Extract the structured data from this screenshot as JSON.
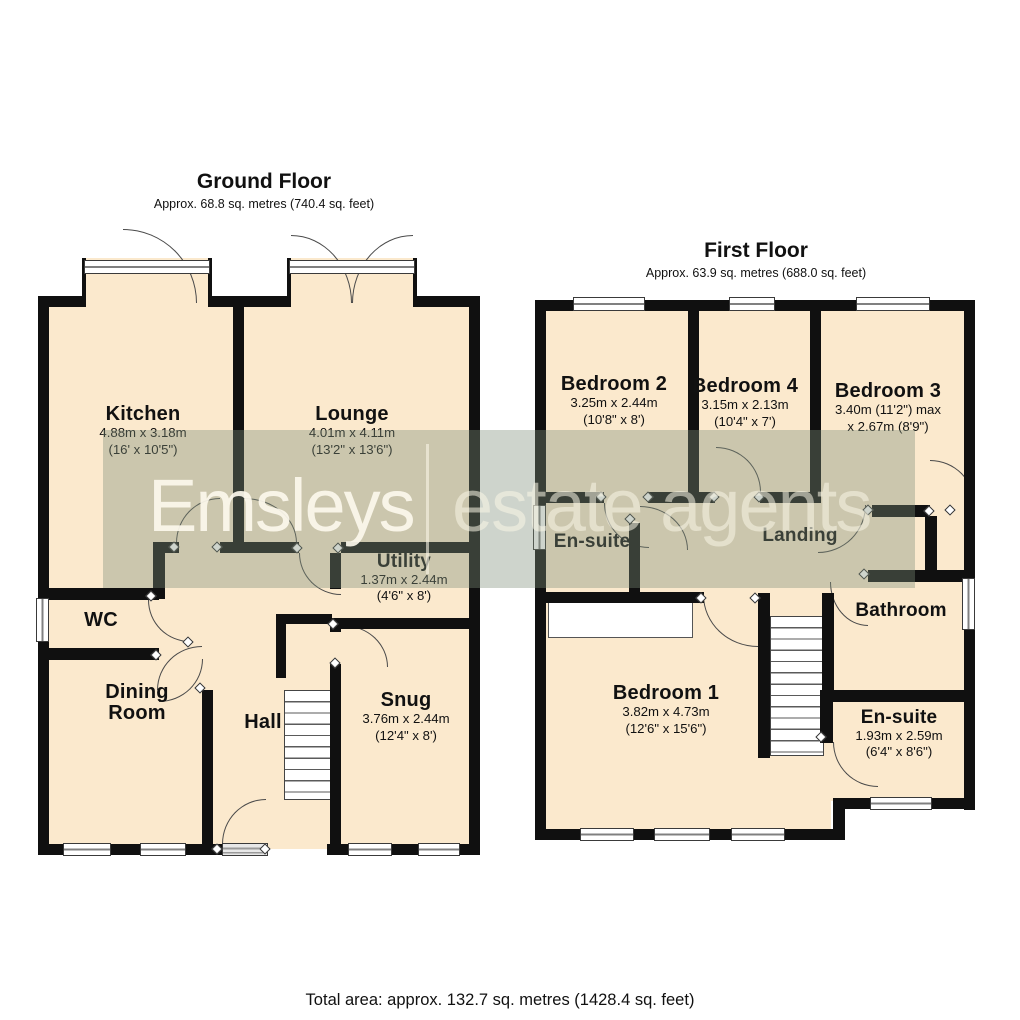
{
  "ground_floor": {
    "title": "Ground Floor",
    "subtitle": "Approx. 68.8 sq. metres (740.4 sq. feet)",
    "rooms": {
      "kitchen": {
        "name": "Kitchen",
        "metric": "4.88m x 3.18m",
        "imperial": "(16' x 10'5\")"
      },
      "lounge": {
        "name": "Lounge",
        "metric": "4.01m x 4.11m",
        "imperial": "(13'2\" x 13'6\")"
      },
      "utility": {
        "name": "Utility",
        "metric": "1.37m x 2.44m",
        "imperial": "(4'6\" x 8')"
      },
      "wc": {
        "name": "WC"
      },
      "dining_room": {
        "name": "Dining Room"
      },
      "hall": {
        "name": "Hall"
      },
      "snug": {
        "name": "Snug",
        "metric": "3.76m x 2.44m",
        "imperial": "(12'4\" x 8')"
      }
    }
  },
  "first_floor": {
    "title": "First Floor",
    "subtitle": "Approx. 63.9 sq. metres (688.0 sq. feet)",
    "rooms": {
      "bedroom2": {
        "name": "Bedroom 2",
        "metric": "3.25m x 2.44m",
        "imperial": "(10'8\" x 8')"
      },
      "bedroom4": {
        "name": "Bedroom 4",
        "metric": "3.15m x 2.13m",
        "imperial": "(10'4\" x 7')"
      },
      "bedroom3": {
        "name": "Bedroom 3",
        "metric": "3.40m (11'2\") max",
        "imperial": "x 2.67m (8'9\")"
      },
      "ensuite_front": {
        "name": "En-suite"
      },
      "landing": {
        "name": "Landing"
      },
      "bathroom": {
        "name": "Bathroom"
      },
      "bedroom1": {
        "name": "Bedroom 1",
        "metric": "3.82m x 4.73m",
        "imperial": "(12'6\" x 15'6\")"
      },
      "ensuite_rear": {
        "name": "En-suite",
        "metric": "1.93m x 2.59m",
        "imperial": "(6'4\" x 8'6\")"
      }
    }
  },
  "watermark": {
    "brand": "Emsleys",
    "suffix": "estate agents"
  },
  "footer": {
    "total_area": "Total area: approx. 132.7 sq. metres (1428.4 sq. feet)"
  },
  "colors": {
    "room_fill": "#fbe9cd",
    "wall": "#101010",
    "watermark_band": "rgba(125,143,120,0.38)"
  }
}
